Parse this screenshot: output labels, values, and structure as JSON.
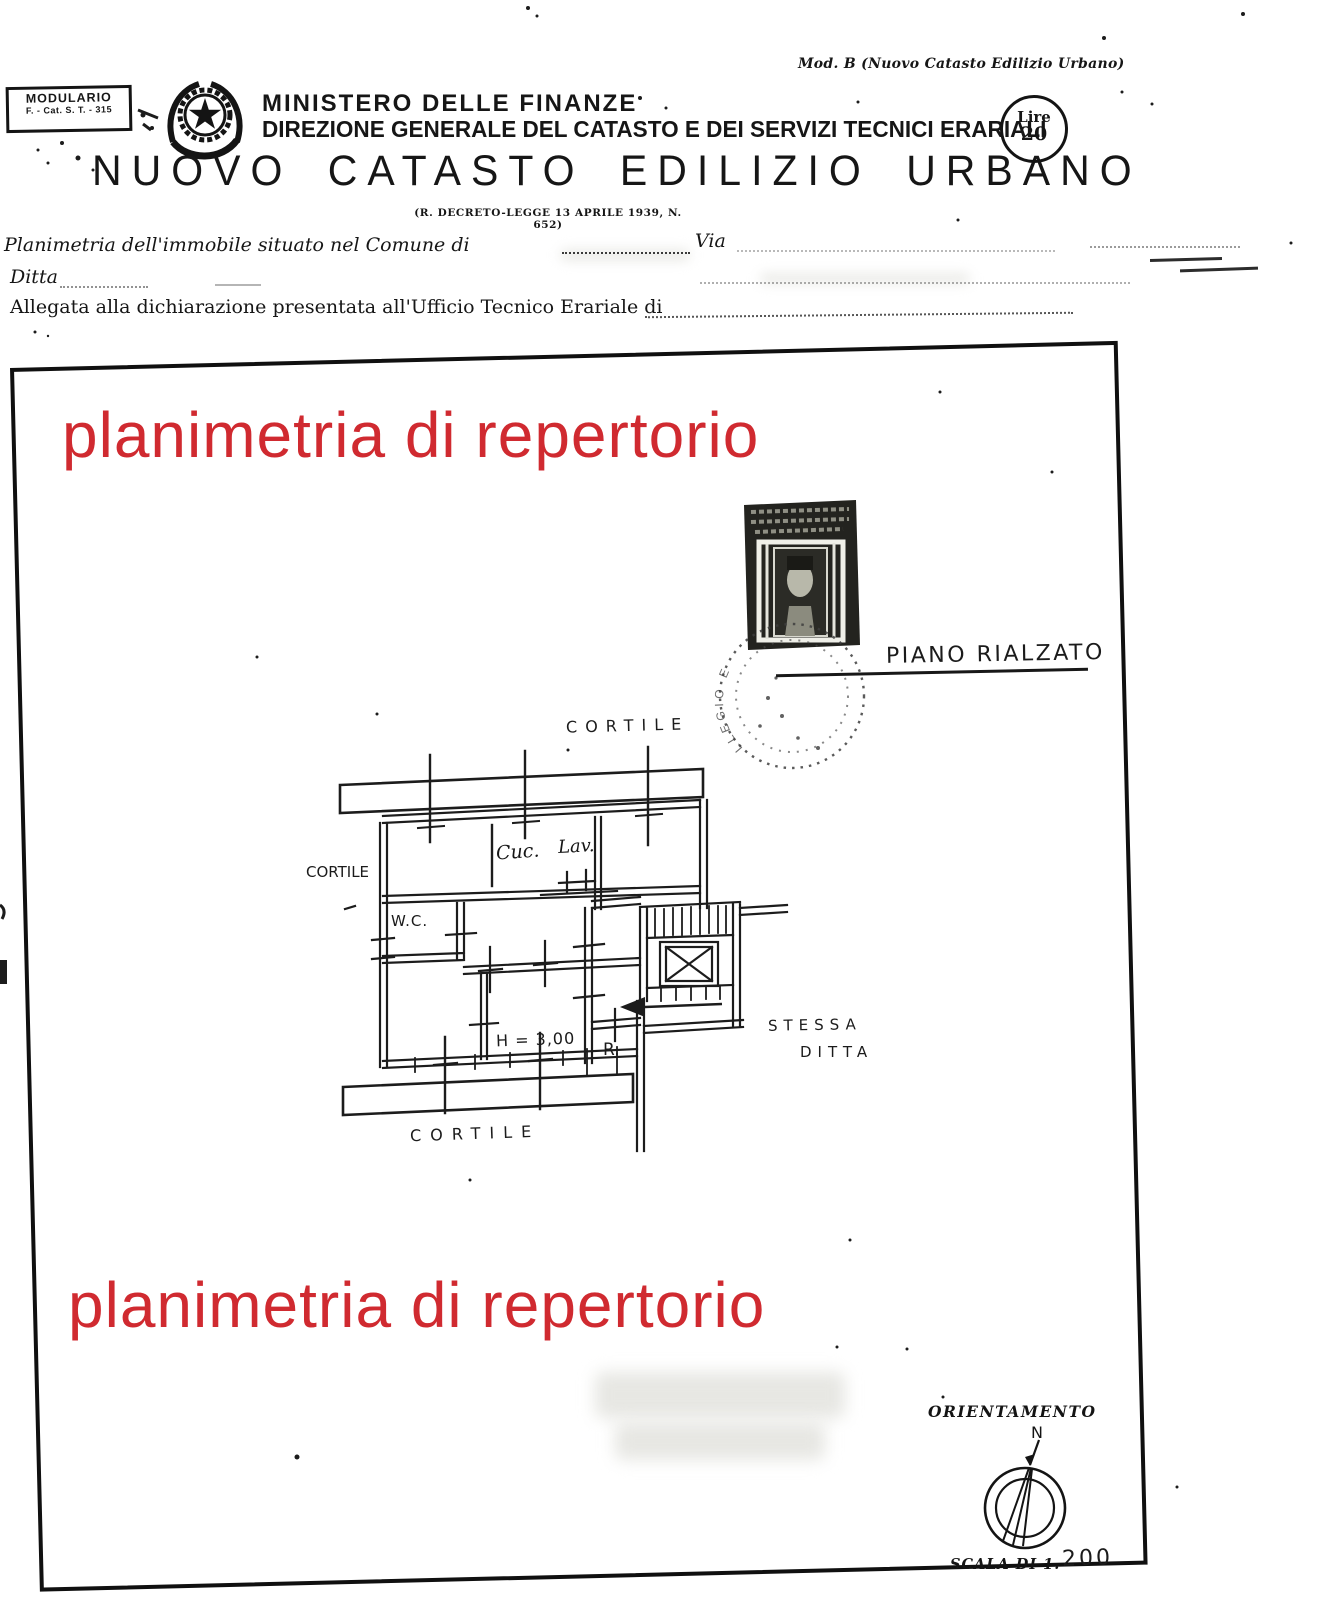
{
  "document": {
    "modulario": {
      "line1": "MODULARIO",
      "line2": "F. - Cat. S. T. - 315"
    },
    "mod_b": "Mod. B (Nuovo Catasto Edilizio Urbano)",
    "ministry": {
      "line1": "MINISTERO DELLE FINANZE",
      "line2": "DIREZIONE GENERALE DEL CATASTO E DEI SERVIZI TECNICI ERARIALI"
    },
    "title": "NUOVO CATASTO EDILIZIO URBANO",
    "subtitle": "(R. DECRETO-LEGGE 13 APRILE 1939, N. 652)",
    "fee_stamp": {
      "line1": "Lire",
      "line2": "20"
    },
    "form": {
      "line1_label": "Planimetria dell'immobile situato nel Comune di",
      "via_label": "Via",
      "line2_label": "Ditta",
      "line3_label": "Allegata alla dichiarazione presentata all'Ufficio Tecnico Erariale di"
    },
    "watermark": {
      "text": "planimetria di repertorio",
      "color": "#d02a30"
    },
    "plan": {
      "floor_label": "PIANO RIALZATO",
      "labels": {
        "courtyard_top": "CORTILE",
        "courtyard_left": "CORTILE",
        "courtyard_bottom": "CORTILE",
        "kitchen": "Cuc.",
        "laundry": "Lav.",
        "wc": "W.C.",
        "height": "H = 3,00",
        "room_r": "R.",
        "neighbor_line1": "STESSA",
        "neighbor_line2": "DITTA"
      }
    },
    "postmark_partial_text": "LLEGIO E",
    "orientation": {
      "label": "ORIENTAMENTO",
      "north": "N",
      "scale_label": "SCALA DI 1.",
      "scale_value": "200"
    }
  }
}
